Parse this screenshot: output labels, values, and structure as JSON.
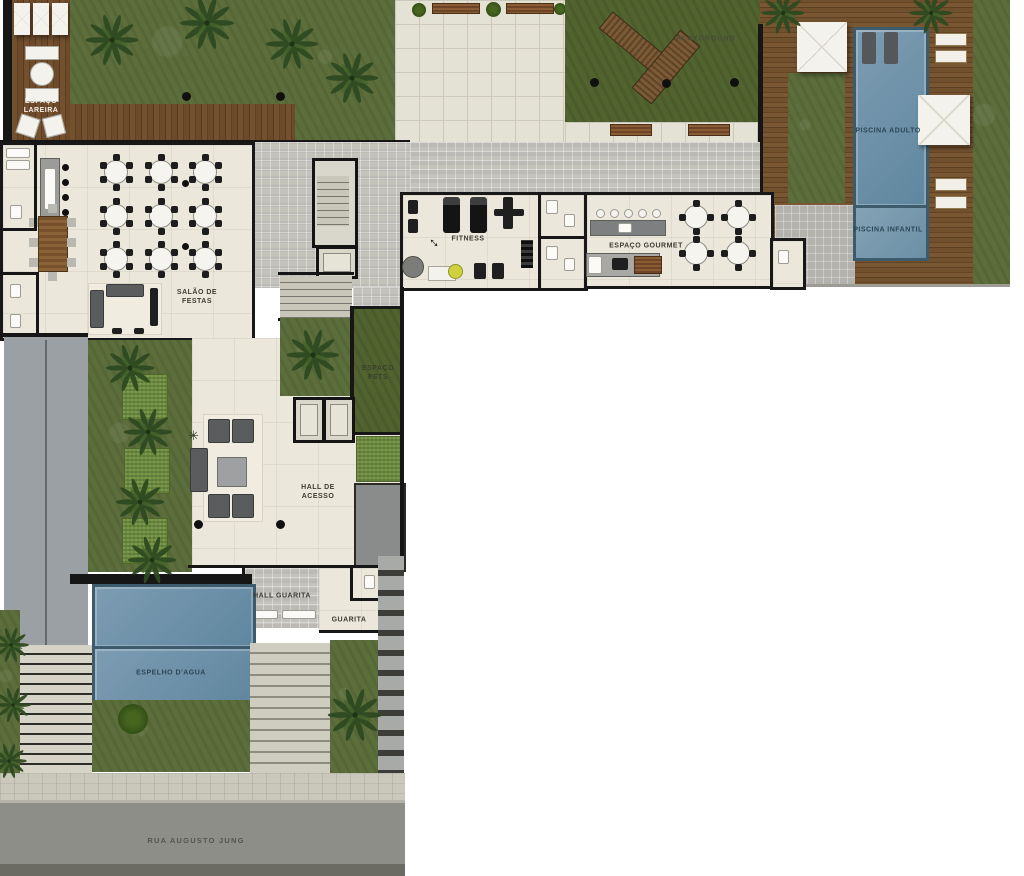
{
  "plan": {
    "areas": {
      "espaco_lareira": {
        "label": "ESPAÇO LAREIRA"
      },
      "playground": {
        "label": "PLAYGROUND"
      },
      "piscina_adulto": {
        "label": "PISCINA ADULTO"
      },
      "piscina_infantil": {
        "label": "PISCINA INFANTIL"
      },
      "salao_de_festas": {
        "label": "SALÃO DE FESTAS"
      },
      "fitness": {
        "label": "FITNESS"
      },
      "espaco_gourmet": {
        "label": "ESPAÇO GOURMET"
      },
      "espaco_pets": {
        "label": "ESPAÇO PETS"
      },
      "hall_de_acesso": {
        "label": "HALL DE ACESSO"
      },
      "hall_guarita": {
        "label": "HALL GUARITA"
      },
      "guarita": {
        "label": "GUARITA"
      },
      "espelho_dagua": {
        "label": "ESPELHO D'AGUA"
      }
    },
    "street": {
      "name": "RUA AUGUSTO JUNG"
    },
    "colors": {
      "grass": "#5c6e3b",
      "wood_deck": "#6f4b2a",
      "pool_water": "#6a8fa8",
      "paving_light": "#e4e1d5",
      "paving_gray": "#c3c2bb",
      "interior_floor": "#ebe7da",
      "wall": "#161616",
      "street": "#8e8e88"
    }
  }
}
